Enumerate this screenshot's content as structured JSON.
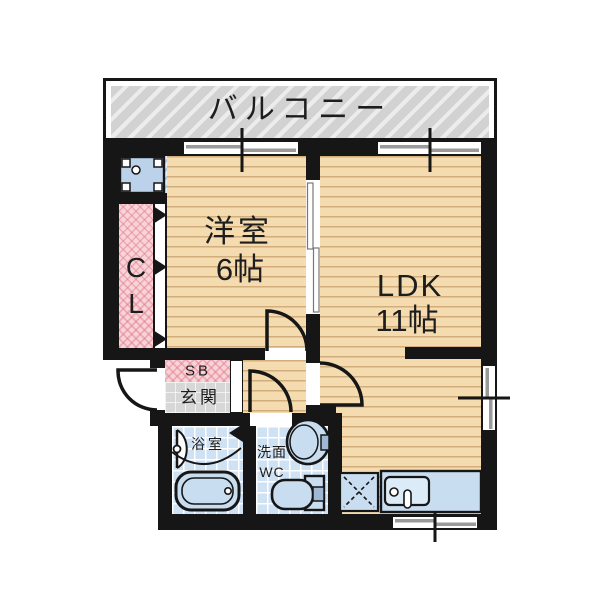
{
  "meta": {
    "type": "floor-plan",
    "style": "japanese-madori"
  },
  "colors": {
    "wall": "#161616",
    "floor": "#f4dcb0",
    "floor_stripe": "#c79e63",
    "balcony_gray": "#d2d2d2",
    "closet_pink": "#f8d3d8",
    "tile_blue": "#cfe2f4",
    "fixture_blue": "#c9ddf1",
    "entrance_gray": "#d7d7d7"
  },
  "labels": {
    "balcony": "バルコニー",
    "western_room": "洋室",
    "western_room_size": "6帖",
    "ldk": "LDK",
    "ldk_size": "11帖",
    "closet_line1": "C",
    "closet_line2": "L",
    "shoe_box": "SB",
    "entrance": "玄関",
    "bathroom": "浴室",
    "washroom_line1": "洗面",
    "washroom_line2": "WC"
  },
  "fixtures": [
    "washing-machine-pan",
    "closet-folding-door",
    "sliding-door-partition",
    "hinged-door-western-room",
    "hinged-door-ldk",
    "hinged-door-washroom",
    "entrance-door",
    "bathroom-door",
    "bathtub",
    "washbasin",
    "toilet",
    "kitchen-sink-counter",
    "refrigerator-space",
    "sliding-window-top-left",
    "sliding-window-top-right",
    "sliding-window-right",
    "sliding-window-bottom"
  ]
}
